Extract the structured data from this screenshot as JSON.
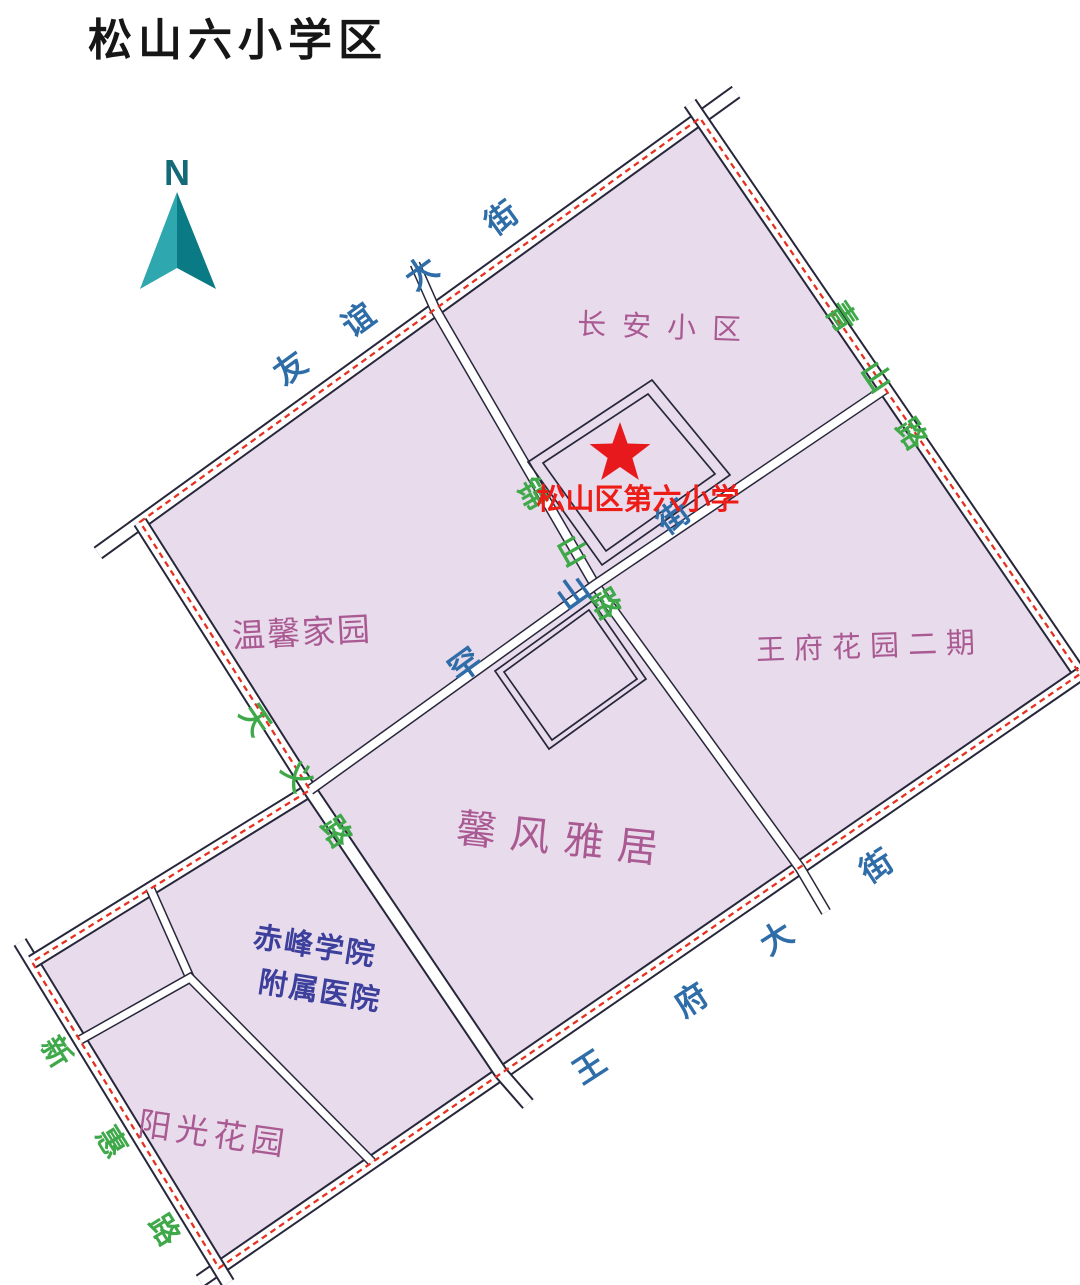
{
  "title": "松山六小学区",
  "compass": {
    "label": "N"
  },
  "school": {
    "name": "松山区第六小学",
    "marker": "red-star",
    "label_color": "#ee1c16",
    "star_color": "#e8191c"
  },
  "roads": {
    "youyi": {
      "name": "友谊大街",
      "type": "street",
      "color": "#2e6da8",
      "chars": [
        "友",
        "谊",
        "大",
        "街"
      ]
    },
    "qingshan": {
      "name": "青山路",
      "type": "road",
      "color": "#3fa94a",
      "chars": [
        "青",
        "山",
        "路"
      ]
    },
    "wangfu": {
      "name": "王府大街",
      "type": "street",
      "color": "#2e6da8",
      "chars": [
        "王",
        "府",
        "大",
        "街"
      ]
    },
    "xinhui": {
      "name": "新惠路",
      "type": "road",
      "color": "#3fa94a",
      "chars": [
        "新",
        "惠",
        "路"
      ]
    },
    "tianyi": {
      "name": "天义路",
      "type": "road",
      "color": "#3fa94a",
      "chars": [
        "天",
        "义",
        "路"
      ]
    },
    "jinshan": {
      "name": "锦山路",
      "type": "road",
      "color": "#3fa94a",
      "chars": [
        "锦",
        "山",
        "路"
      ]
    },
    "hanshan": {
      "name": "罕山街",
      "type": "street",
      "color": "#2e6da8",
      "chars": [
        "罕",
        "山",
        "街"
      ]
    }
  },
  "districts": {
    "changan": {
      "name": "长安小区"
    },
    "wenxin": {
      "name": "温馨家园"
    },
    "wangfu2": {
      "name": "王府花园二期"
    },
    "xinfeng": {
      "name": "馨风雅居"
    },
    "yangguang": {
      "name": "阳光花园"
    },
    "hospital": {
      "name_line1": "赤峰学院",
      "name_line2": "附属医院"
    }
  },
  "colors": {
    "block_fill": "#e8dcec",
    "line": "#27273b",
    "boundary_dash": "#e7301f",
    "street_label_blue": "#2e6da8",
    "road_label_green": "#3fa94a",
    "district_label": "#aa5a92",
    "hospital_label": "#3c3f9b",
    "north_arrow_light": "#2ea7ae",
    "north_arrow_dark": "#0a7a85"
  }
}
